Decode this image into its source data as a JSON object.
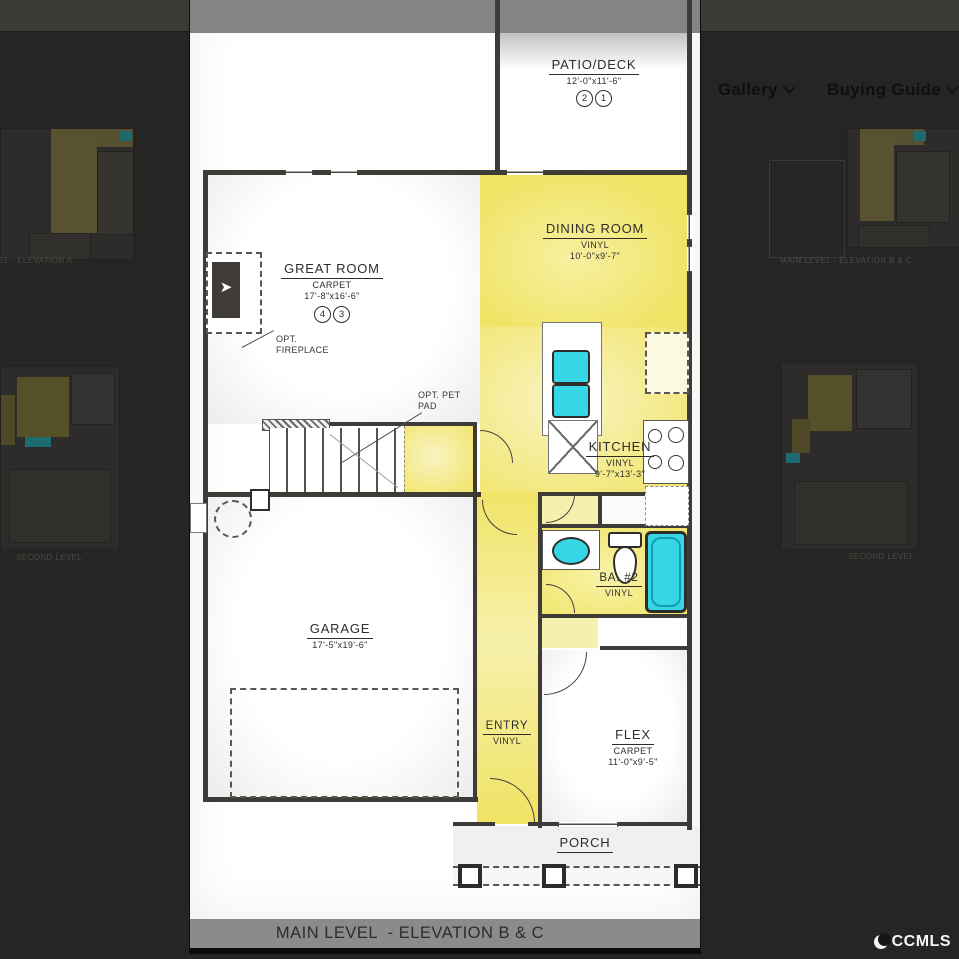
{
  "header": {
    "gallery_label": "Gallery",
    "buying_guide_label": "Buying Guide"
  },
  "watermark": {
    "label": "CCMLS"
  },
  "icons": {
    "chevron_down": "css-chevron-shape",
    "ccmls_logo": "crescent-moon-shape"
  },
  "gallery_thumbs": {
    "left_top_caption": "MAIN LEVEL - ELEVATION A",
    "left_bottom_caption": "SECOND LEVEL",
    "right_top_caption": "MAIN LEVEL - ELEVATION B & C",
    "right_bottom_caption": "SECOND LEVEL"
  },
  "floorplan": {
    "caption": "MAIN LEVEL  - ELEVATION B & C",
    "rooms": {
      "patio": {
        "name": "PATIO/DECK",
        "dims": "12'-0\"x11'-6\"",
        "tags": [
          "2",
          "1"
        ]
      },
      "great_room": {
        "name": "GREAT ROOM",
        "floor": "CARPET",
        "dims": "17'-8\"x16'-6\"",
        "tags": [
          "4",
          "3"
        ]
      },
      "dining": {
        "name": "DINING ROOM",
        "floor": "VINYL",
        "dims": "10'-0\"x9'-7\""
      },
      "kitchen": {
        "name": "KITCHEN",
        "floor": "VINYL",
        "dims": "9'-7\"x13'-3\""
      },
      "garage": {
        "name": "GARAGE",
        "dims": "17'-5\"x19'-6\""
      },
      "entry": {
        "name": "ENTRY",
        "floor": "VINYL"
      },
      "bath": {
        "name": "BA. #2",
        "floor": "VINYL"
      },
      "flex": {
        "name": "FLEX",
        "floor": "CARPET",
        "dims": "11'-0\"x9'-5\""
      },
      "porch": {
        "name": "PORCH"
      }
    },
    "annotations": {
      "fireplace": "OPT. FIREPLACE",
      "pet_pad": "OPT. PET PAD"
    }
  },
  "colors": {
    "overlay_bg": "#272523",
    "topbar_bg": "#3c3b38",
    "room_yellow": "#f0e365",
    "fixture_cyan": "#35d6e6",
    "wall": "#3f3c38",
    "caption_band": "#8b8b8b"
  }
}
